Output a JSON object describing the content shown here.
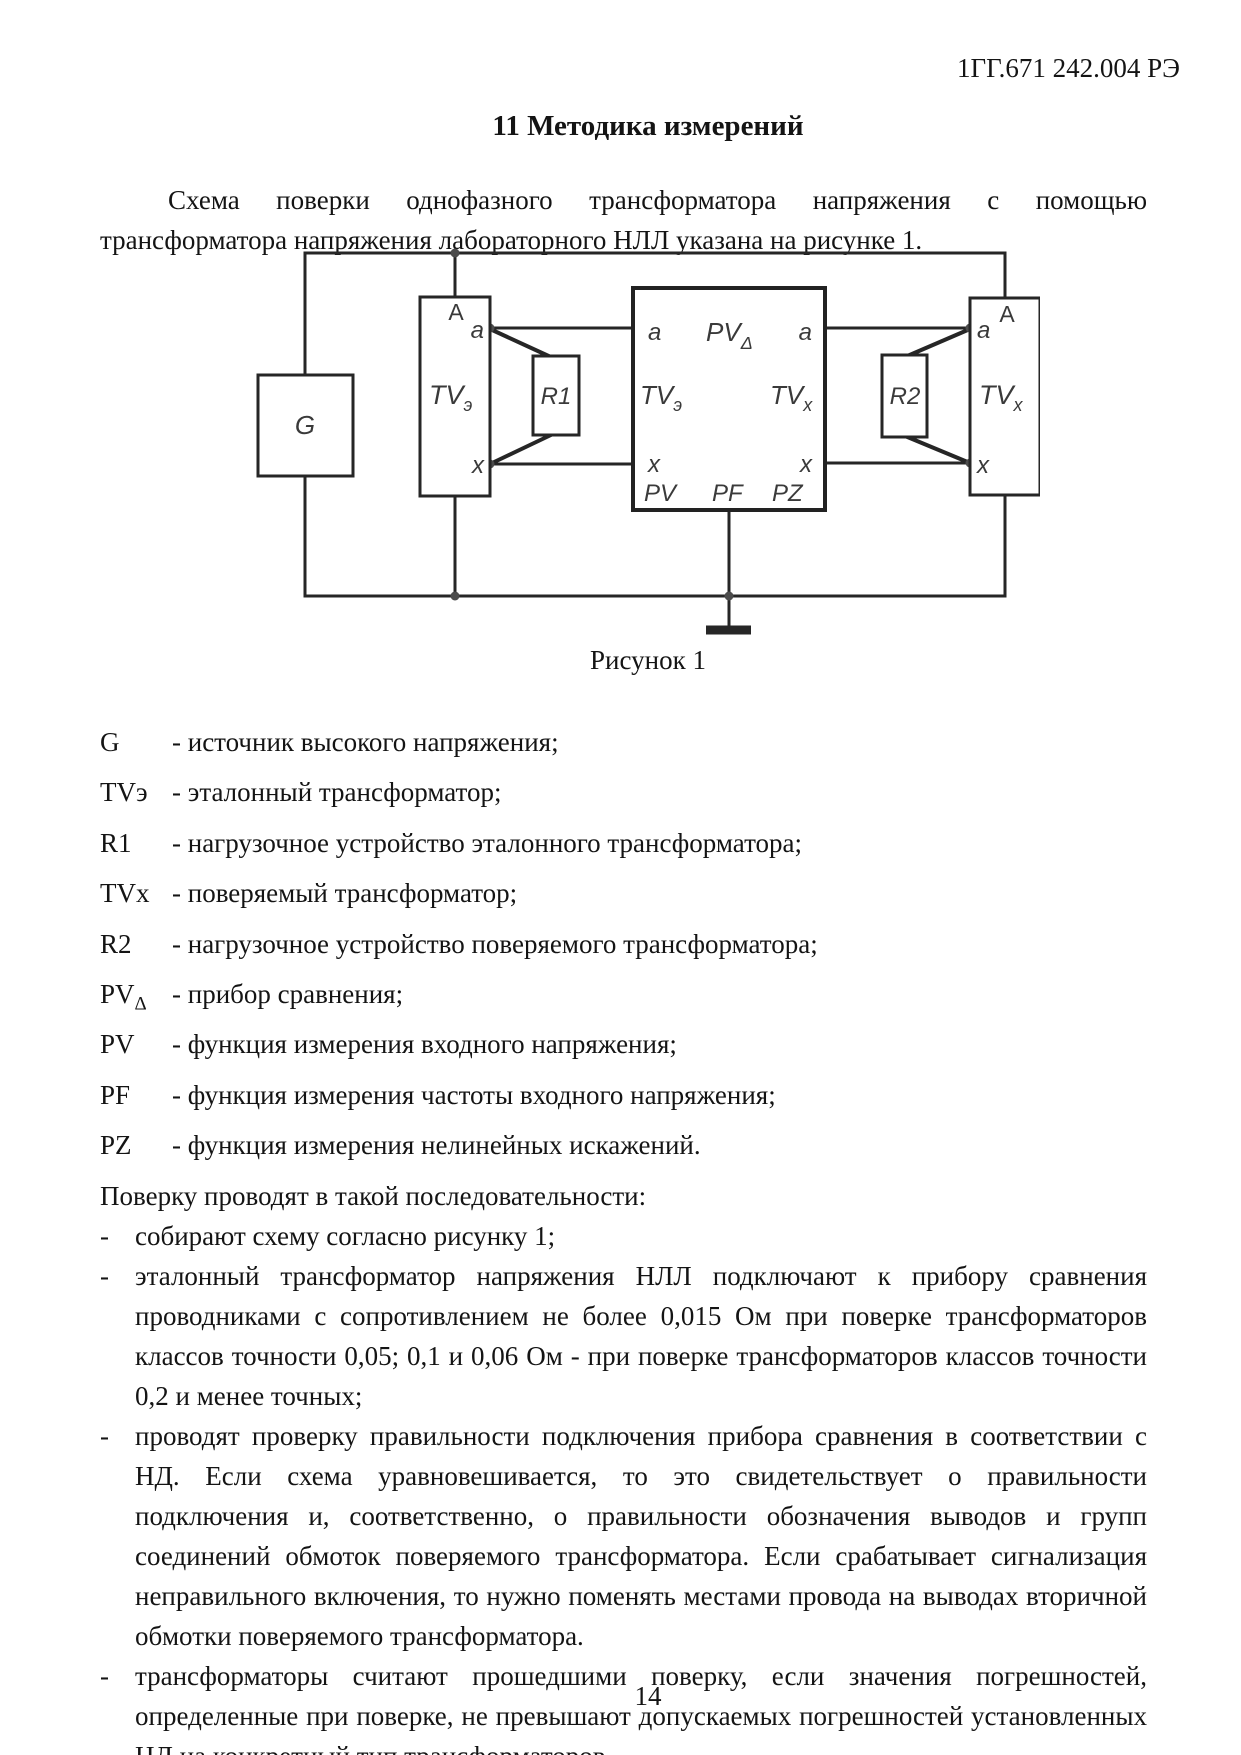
{
  "page": {
    "header": "1ГГ.671 242.004 РЭ",
    "section_title": "11   Методика измерений",
    "intro": "Схема поверки однофазного трансформатора напряжения с помощью трансформатора напряжения лабораторного НЛЛ указана на рисунке 1.",
    "figure_caption": "Рисунок 1",
    "page_number": "14"
  },
  "diagram": {
    "labels": {
      "g": "G",
      "a_upper": "A",
      "a": "a",
      "x": "x",
      "tv": "TV",
      "sub_e": "э",
      "sub_x": "х",
      "r1": "R1",
      "r2": "R2",
      "pv": "PV",
      "sub_delta": "Δ",
      "pf": "PF",
      "pz": "PZ"
    }
  },
  "legend": {
    "items": [
      {
        "term": "G",
        "sub": "",
        "desc": "- источник высокого напряжения;"
      },
      {
        "term": "TVэ",
        "sub": "",
        "desc": "- эталонный трансформатор;"
      },
      {
        "term": "R1",
        "sub": "",
        "desc": "- нагрузочное устройство эталонного трансформатора;"
      },
      {
        "term": "TVх",
        "sub": "",
        "desc": "- поверяемый трансформатор;"
      },
      {
        "term": "R2",
        "sub": "",
        "desc": "- нагрузочное устройство поверяемого трансформатора;"
      },
      {
        "term": "PV",
        "sub": "Δ",
        "desc": "- прибор сравнения;"
      },
      {
        "term": "PV",
        "sub": "",
        "desc": "- функция измерения входного напряжения;"
      },
      {
        "term": "PF",
        "sub": "",
        "desc": "- функция измерения частоты входного напряжения;"
      },
      {
        "term": "PZ",
        "sub": "",
        "desc": "- функция измерения нелинейных искажений."
      }
    ]
  },
  "procedure": {
    "lead": "Поверку проводят в такой последовательности:",
    "marker": "-",
    "items": [
      "собирают схему согласно рисунку 1;",
      "эталонный трансформатор напряжения НЛЛ подключают к прибору сравнения проводниками с сопротивлением не более 0,015 Ом при поверке трансформаторов классов точности 0,05; 0,1 и 0,06 Ом - при поверке трансформаторов классов точности 0,2 и менее точных;",
      "проводят проверку правильности подключения прибора сравнения в соответствии с НД. Если схема уравновешивается, то это свидетельствует о правильности подключения и, соответственно, о правильности обозначения выводов и групп соединений обмоток поверяемого трансформатора. Если срабатывает сигнализация неправильного включения, то нужно поменять местами провода на выводах вторичной обмотки поверяемого трансформатора.",
      "трансформаторы считают прошедшими поверку, если значения погрешностей, определенные при поверке, не превышают допускаемых погрешностей установленных НД на конкретный тип трансформаторов."
    ]
  }
}
